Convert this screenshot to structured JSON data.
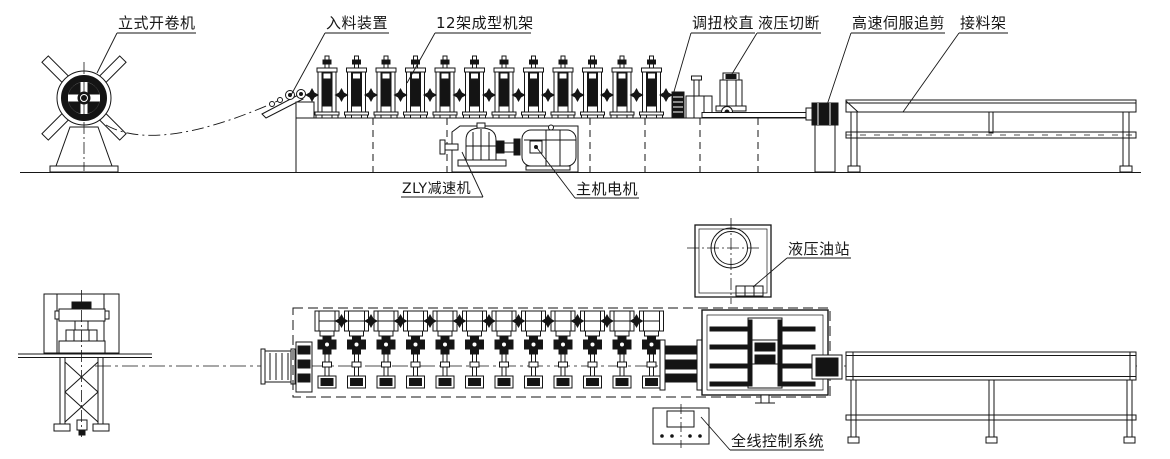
{
  "drawing": {
    "type": "engineering-layout-drawing",
    "views": {
      "top": "elevation",
      "bottom": "plan"
    },
    "colors": {
      "line": "#161616",
      "background": "#ffffff",
      "fill_dark": "#141414"
    }
  },
  "labels": {
    "uncoiler": "立式开卷机",
    "infeed": "入料装置",
    "forming_stands": "12架成型机架",
    "straightener": "调扭校直",
    "hydraulic_cutoff": "液压切断",
    "servo_shear": "高速伺服追剪",
    "outfeed_rack": "接料架",
    "reducer": "ZLY减速机",
    "main_motor": "主机电机",
    "oil_station": "液压油站",
    "control_system": "全线控制系统"
  }
}
